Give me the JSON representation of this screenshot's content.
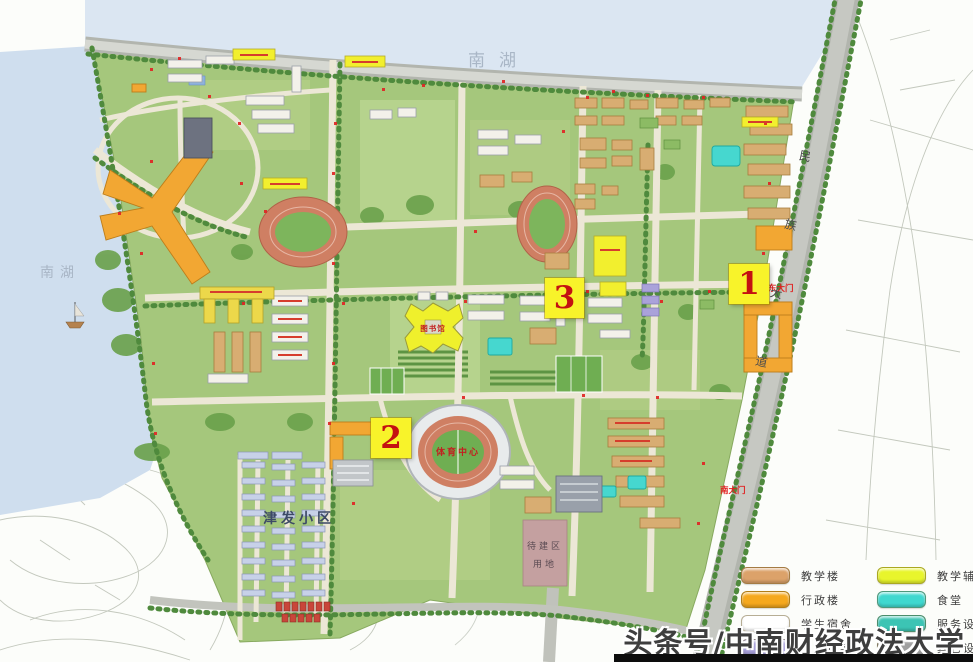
{
  "watermark": {
    "text": "头条号/中南财经政法大学"
  },
  "markers": {
    "m1": "1",
    "m2": "2",
    "m3": "3"
  },
  "labels": {
    "lake_top": "南湖",
    "lake_left": "南湖",
    "residential": "津发小区",
    "stadium": "体育中心",
    "library": "图书馆",
    "gate_east": "东大门",
    "gate_south": "南大门",
    "road_east": "民族大道",
    "plot_line1": "待建区",
    "plot_line2": "用地"
  },
  "legend": {
    "rows": [
      {
        "color": "#dca26a",
        "label": "教学楼"
      },
      {
        "color": "#e8f52c",
        "label": "教学辅助设施"
      },
      {
        "color": "#f5a81e",
        "label": "行政楼"
      },
      {
        "color": "#3fd8cf",
        "label": "食堂"
      },
      {
        "color": "#ffffff",
        "label": "学生宿舍"
      },
      {
        "color": "#3cc4b4",
        "label": "服务设施"
      },
      {
        "color": "#a79fd8",
        "label": "教工住宅"
      },
      {
        "color": "#a0a0a0",
        "label": "其它设施"
      }
    ]
  }
}
